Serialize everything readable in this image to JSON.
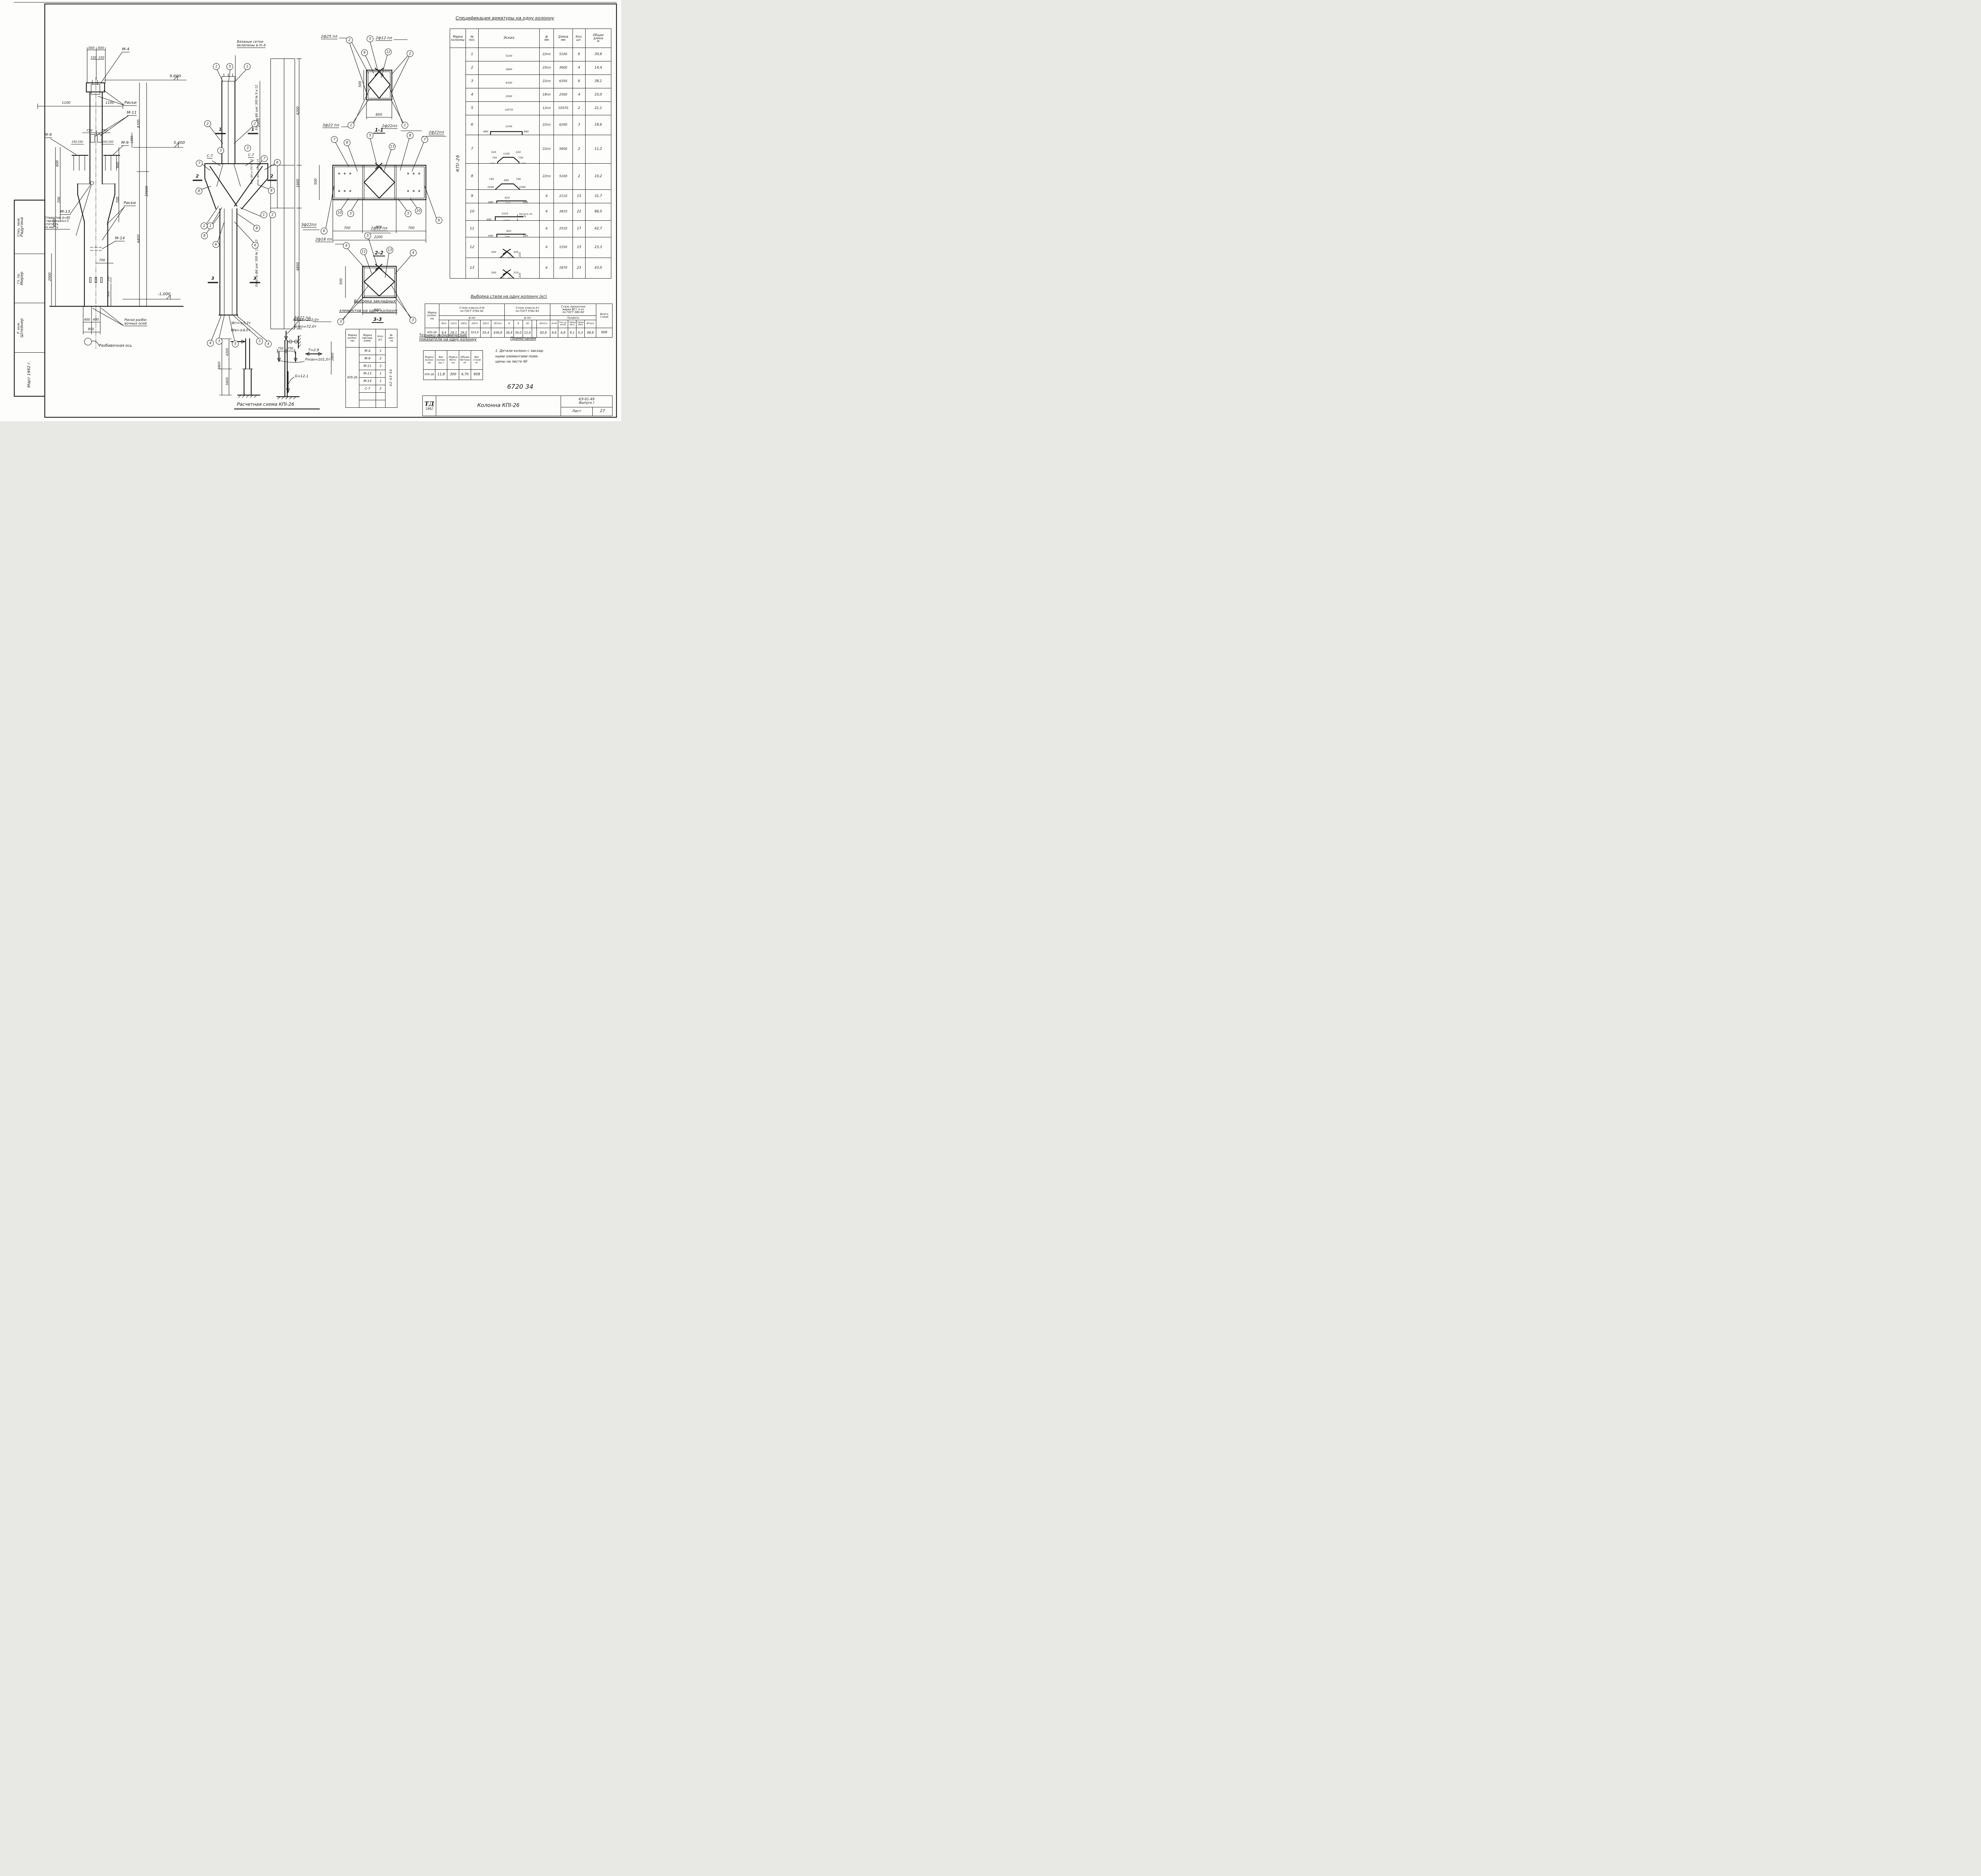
{
  "stamp": {
    "r1_role": "Спец. пров.",
    "r1_name": "Радугина",
    "r2_role": "Гл. пр.",
    "r2_name": "Мирер",
    "r3_role": "Р. инж.",
    "r3_name": "Штейнер",
    "date": "Март 1962 г."
  },
  "left_view": {
    "m4": "М-4",
    "m11": "М-11",
    "m9": "М-9",
    "m13": "М-13",
    "m14": "М-14",
    "riski": "Риски",
    "elev_top": "9.600",
    "elev_mid": "5.400",
    "elev_bot": "-1,000",
    "d300a": "300",
    "d300b": "300",
    "d150a": "150",
    "d150b": "150",
    "d1100a": "1100",
    "d1100b": "1100",
    "d4200": "4200",
    "d10600": "10600",
    "d6400": "6400",
    "d1350": "1350",
    "d750a": "750",
    "d750b": "750",
    "d250a": "250",
    "d250b": "250",
    "d250c": "250",
    "d250d": "250",
    "d600": "600",
    "d900": "900",
    "d700a": "700",
    "d700b": "700",
    "d700c": "700",
    "d4700": "4700",
    "d2000": "2000",
    "d850": "850",
    "d190": "190",
    "d400a": "400",
    "d400b": "400",
    "d800": "800",
    "hole_note": "Отверстие d=80\nстержень поз.5\nотогнуть\nпо месту",
    "axes_note": "Риски разби-\nвочных осей",
    "axis_label": "Разбивочная ось"
  },
  "mid_view": {
    "note": "Вязаные сетки\nвключены в m-4",
    "c7": "С-7",
    "mark1": "1",
    "mark2": "2",
    "mark3": "3",
    "strip1": "Хомуты ф6 шаг 300 № 9 и 12",
    "strip2a": "Хом. ф8 ш.150 № 10",
    "strip2b": "Хом. ф6 ш.300 № 13",
    "strip3": "Хомуты ф6 шаг 300 № 11 и 13",
    "sd2600": "2600",
    "sd4200": "4200",
    "sd1600": "1600",
    "sd4800": "4800",
    "circles": [
      "1",
      "5",
      "1",
      "2",
      "2",
      "3",
      "3",
      "7",
      "7",
      "6",
      "8",
      "8",
      "2",
      "1",
      "8",
      "6",
      "1",
      "2",
      "8",
      "6",
      "4",
      "3",
      "5",
      "3",
      "4"
    ]
  },
  "s11": {
    "title": "1-1",
    "n25": "2ф25 пл",
    "n12": "2ф12 пл",
    "n22": "3ф22 пл",
    "w": "600",
    "h": "500",
    "c": [
      "2",
      "5",
      "9",
      "12",
      "2",
      "1",
      "1"
    ]
  },
  "s22": {
    "title": "2-2",
    "n22a": "2ф22пл",
    "n22b": "2ф22пл",
    "n22c": "3ф22пл",
    "h": "500",
    "d1": "700",
    "d2": "800",
    "d3": "700",
    "w": "2200",
    "c": [
      "7",
      "8",
      "5",
      "13",
      "8",
      "7",
      "10",
      "3",
      "3",
      "10",
      "6",
      "6"
    ]
  },
  "s33": {
    "title": "3-3",
    "n18": "2ф18 пл",
    "n12": "2ф12 пл",
    "n22": "3ф22 пл",
    "h": "500",
    "w": "800",
    "c": [
      "4",
      "11",
      "5",
      "13",
      "4",
      "3",
      "3"
    ]
  },
  "scheme": {
    "title": "Расчетная схема КПІ-26",
    "wt": "Wт=±3,3т",
    "wb": "Wв=±4,0т",
    "d4200": "4200",
    "d5600": "5600",
    "d9800": "9800",
    "nmax": "Nmax=202,0т",
    "nmin": "Nmin=72,0т",
    "d750a": "750",
    "d750b": "750",
    "t": "Т=2,9",
    "d2800": "2800",
    "pmax": "Pmax=101,0т",
    "g": "G=12,1"
  },
  "spec": {
    "title": "Спецификация арматуры на одну колонну",
    "h": {
      "mark": "Марка\nколонны",
      "pos": "№\nпоз.",
      "sketch": "Эскиз",
      "dia": "ф\nмм",
      "len": "Длина\nмм",
      "qty": "Кол.\nшт.",
      "total": "Общая\nдлина\nм"
    },
    "mark": "КПІ-26",
    "rows": [
      {
        "pos": "1",
        "d1": "5100",
        "dia": "22пл",
        "len": "5100",
        "qty": "6",
        "total": "30,6"
      },
      {
        "pos": "2",
        "d1": "3600",
        "dia": "25пл",
        "len": "3600",
        "qty": "4",
        "total": "14,4"
      },
      {
        "pos": "3",
        "d1": "6350",
        "dia": "22пл",
        "len": "6350",
        "qty": "6",
        "total": "38,1"
      },
      {
        "pos": "4",
        "d1": "2500",
        "dia": "18пл",
        "len": "2500",
        "qty": "4",
        "total": "10,0"
      },
      {
        "pos": "5",
        "d1": "10570",
        "dia": "12пл",
        "len": "10570",
        "qty": "2",
        "total": "21,1"
      },
      {
        "pos": "6",
        "top": "2140",
        "s1": "860",
        "s2": "860",
        "g1": "1170",
        "g2": "1170",
        "b1": "830",
        "b2": "830",
        "dia": "22пл",
        "len": "6200",
        "qty": "3",
        "total": "18,6"
      },
      {
        "pos": "7",
        "t1": "520",
        "t2": "1100",
        "t3": "520",
        "u1": "730",
        "u2": "730",
        "s1": "340",
        "s2": "340",
        "g1": "1180",
        "g2": "1180",
        "b1": "840",
        "b2": "840",
        "dia": "22пл",
        "len": "5600",
        "qty": "2",
        "total": "11,2"
      },
      {
        "pos": "8",
        "t1": "740",
        "t2": "660",
        "t3": "740",
        "u1": "1040",
        "u2": "1040",
        "g1": "1180",
        "g2": "1180",
        "b1": "840",
        "b2": "840",
        "dia": "22пл",
        "len": "5100",
        "qty": "2",
        "total": "10,2"
      },
      {
        "pos": "9",
        "top": "610",
        "left": "440",
        "mid": "540",
        "right": "520",
        "dia": "6",
        "len": "2110",
        "qty": "15",
        "total": "31,7"
      },
      {
        "pos": "10",
        "top": "1510",
        "left": "440",
        "mid": "1960",
        "note": "Загнуть по месту",
        "dia": "8",
        "len": "3910",
        "qty": "22",
        "total": "86,0"
      },
      {
        "pos": "11",
        "top": "810",
        "left": "440",
        "mid": "740",
        "right": "520",
        "dia": "6",
        "len": "2510",
        "qty": "17",
        "total": "42,7"
      },
      {
        "pos": "12",
        "a": "420",
        "b": "430",
        "c1": "350",
        "c2": "350",
        "d": "270",
        "e1": "220",
        "e2": "220",
        "dia": "6",
        "len": "1550",
        "qty": "15",
        "total": "23,3"
      },
      {
        "pos": "13",
        "a": "500",
        "b": "510",
        "c1": "430",
        "c2": "430",
        "d": "370",
        "e1": "220",
        "e2": "220",
        "dia": "6",
        "len": "1870",
        "qty": "23",
        "total": "43,0"
      }
    ]
  },
  "steel": {
    "title": "Выборка стали на одну колонну (кг)",
    "mark_h": "Марка\nколон-\nны",
    "g1": "Сталь класса А-III\nпо ГОСТ 5781-61",
    "g2": "Сталь класса А-I\nпо ГОСТ 5781-61",
    "g3": "Сталь прокатная\nмарки ВСт.3 кп\nпо ГОСТ 380-60",
    "total_h": "Всего\nстали",
    "fmm1": "ф мм",
    "fmm2": "ф мм",
    "prof": "Профиль",
    "c1": [
      "8пл",
      "12пл",
      "18пл",
      "22пл",
      "25пл",
      "Итого"
    ],
    "c2": [
      "6",
      "8",
      "20",
      "",
      "Итого"
    ],
    "c3": [
      "δ=8",
      "Газ.тр.\nd=50",
      "Гайки\nМ12",
      "Гайки\nМ16",
      "Итого"
    ],
    "mark": "КПІ-26",
    "v1": [
      "9,4",
      "28,1",
      "29,0",
      "323,9",
      "55,4",
      "436,8"
    ],
    "v2": [
      "36,4",
      "34,0",
      "12,4",
      "",
      "82,8"
    ],
    "v3": [
      "8,6",
      "6,8",
      "9,1",
      "0,3",
      "88,8"
    ],
    "total": "608"
  },
  "embed": {
    "title1": "Выборка закладных",
    "title2": "элементов на одну колонну",
    "h": [
      "Марка\nколон-\nны",
      "Марка\nзаклад.\nэлем.",
      "Кол.\nшт.",
      "№\nлис-\nта"
    ],
    "mark": "КПІ-26",
    "rows": [
      [
        "М-4",
        "1"
      ],
      [
        "М-9",
        "2"
      ],
      [
        "М-11",
        "2"
      ],
      [
        "М-13",
        "1"
      ],
      [
        "М-14",
        "1"
      ],
      [
        "С-7",
        "2"
      ],
      [
        "",
        ""
      ],
      [
        "",
        ""
      ]
    ],
    "sheets": "42·43·44"
  },
  "tech": {
    "title": "Технико-экономические\nпоказатели на одну колонну",
    "h": [
      "Марка\nколон-\nны",
      "Вес\nколон-\nны,т",
      "Марка\nбето-\nна",
      "Объем\nбетона\nм³",
      "Вес\nстали\nкг"
    ],
    "row": [
      "КПІ-26",
      "11,8",
      "300",
      "4,70",
      "608"
    ]
  },
  "notes": {
    "title": "Примечания",
    "body": "1. Детали колонн с заклад-\nными элементами поме-\nщены на листе 40"
  },
  "doc_no": "6720 34",
  "tb": {
    "logo": "ТД",
    "year": "1962",
    "name": "Колонна КПІ-26",
    "code": "КЭ-01-49",
    "issue": "Выпуск I",
    "sheet_lbl": "Лист",
    "sheet": "27"
  }
}
